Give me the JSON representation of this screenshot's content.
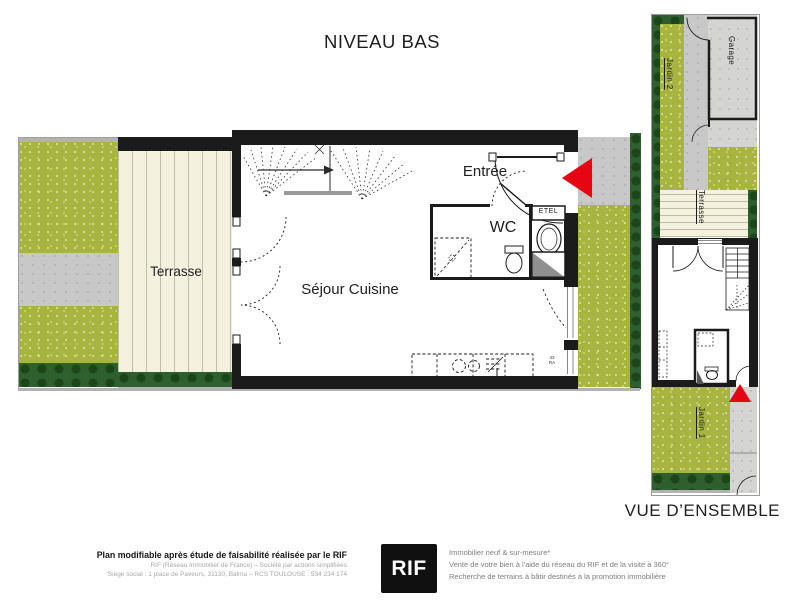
{
  "page": {
    "title": "NIVEAU BAS"
  },
  "main_plan": {
    "terrace_label": "Terrasse",
    "living_label": "Séjour Cuisine",
    "entry_label": "Entrée",
    "wc_label": "WC",
    "etel_label": "ETEL",
    "kitchen_note": "43 RA"
  },
  "overview": {
    "title": "VUE D’ENSEMBLE",
    "garden2_label": "Jardin 2",
    "garage_label": "Garage",
    "terrace_label": "Terrasse",
    "garden1_label": "Jardin 1"
  },
  "footer": {
    "disclaimer": "Plan modifiable après étude de faisabilité réalisée par le RIF",
    "legal_line1": "RIF (Réseau Immobilier de France) – Société par actions simplifiées",
    "legal_line2": "Siège social : 1 place de Paveurs, 31130, Balma – RCS TOULOUSE : 534 234 174",
    "logo_text": "RIF",
    "services_line1": "Immobilier neuf & sur-mesure*",
    "services_line2": "Vente de votre bien à l'aide du réseau du RIF et de la visite à 360°",
    "services_line3": "Recherche de terrains à bâtir destinés à la promotion immobilière"
  },
  "colors": {
    "grass": "#a8b440",
    "dark_green": "#2f5f2e",
    "path_gray": "#c8c8c8",
    "concrete": "#d4d4d2",
    "deck_cream": "#f4f1de",
    "wall_black": "#1b1b1b",
    "arrow_red": "#e60613"
  }
}
